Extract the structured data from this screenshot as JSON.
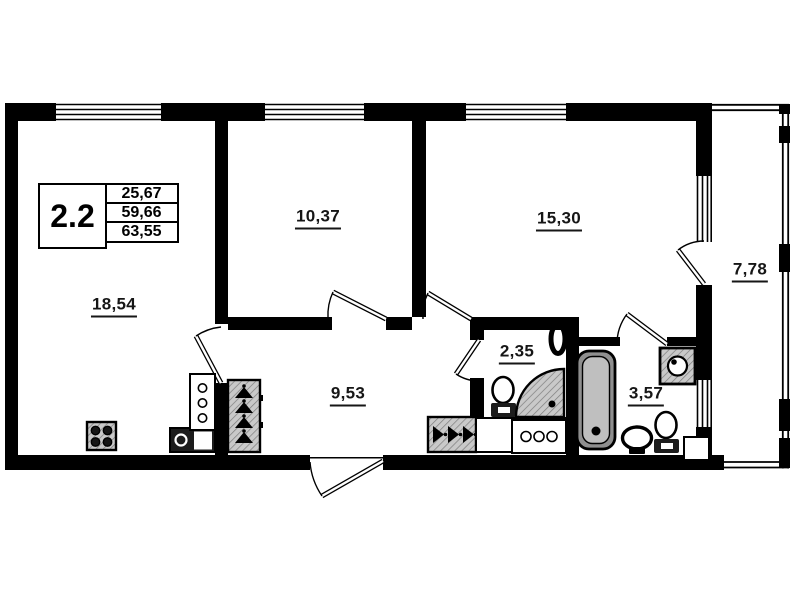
{
  "title_block": {
    "unit_number": "2.2",
    "values": [
      "25,67",
      "59,66",
      "63,55"
    ]
  },
  "room_labels": {
    "living_room": "18,54",
    "bedroom": "10,37",
    "kitchen_living_room": "15,30",
    "hallway": "9,53",
    "wc": "2,35",
    "bathroom": "3,57",
    "balcony": "7,78"
  },
  "colors": {
    "walls": "#000000",
    "background": "#ffffff",
    "hatch_fill": "#c9c9c9",
    "hatch_line": "#7d7d7d",
    "tub_outer": "#8f8f8f",
    "tub_inner": "#bfbfbf"
  },
  "fixtures": [
    "stove-icon",
    "kitchen-sink-icon",
    "refrigerator-icon",
    "wardrobe-hangers-icon",
    "entry-closet-hangers-icon",
    "cabinet-icon",
    "chest-of-drawers-icon",
    "toilet-icon",
    "corner-shower-icon",
    "towel-radiator-icon",
    "bathtub-icon",
    "washing-machine-icon",
    "washbasin-icon",
    "duct-shaft",
    "window-symbol",
    "door-swing-symbol"
  ]
}
